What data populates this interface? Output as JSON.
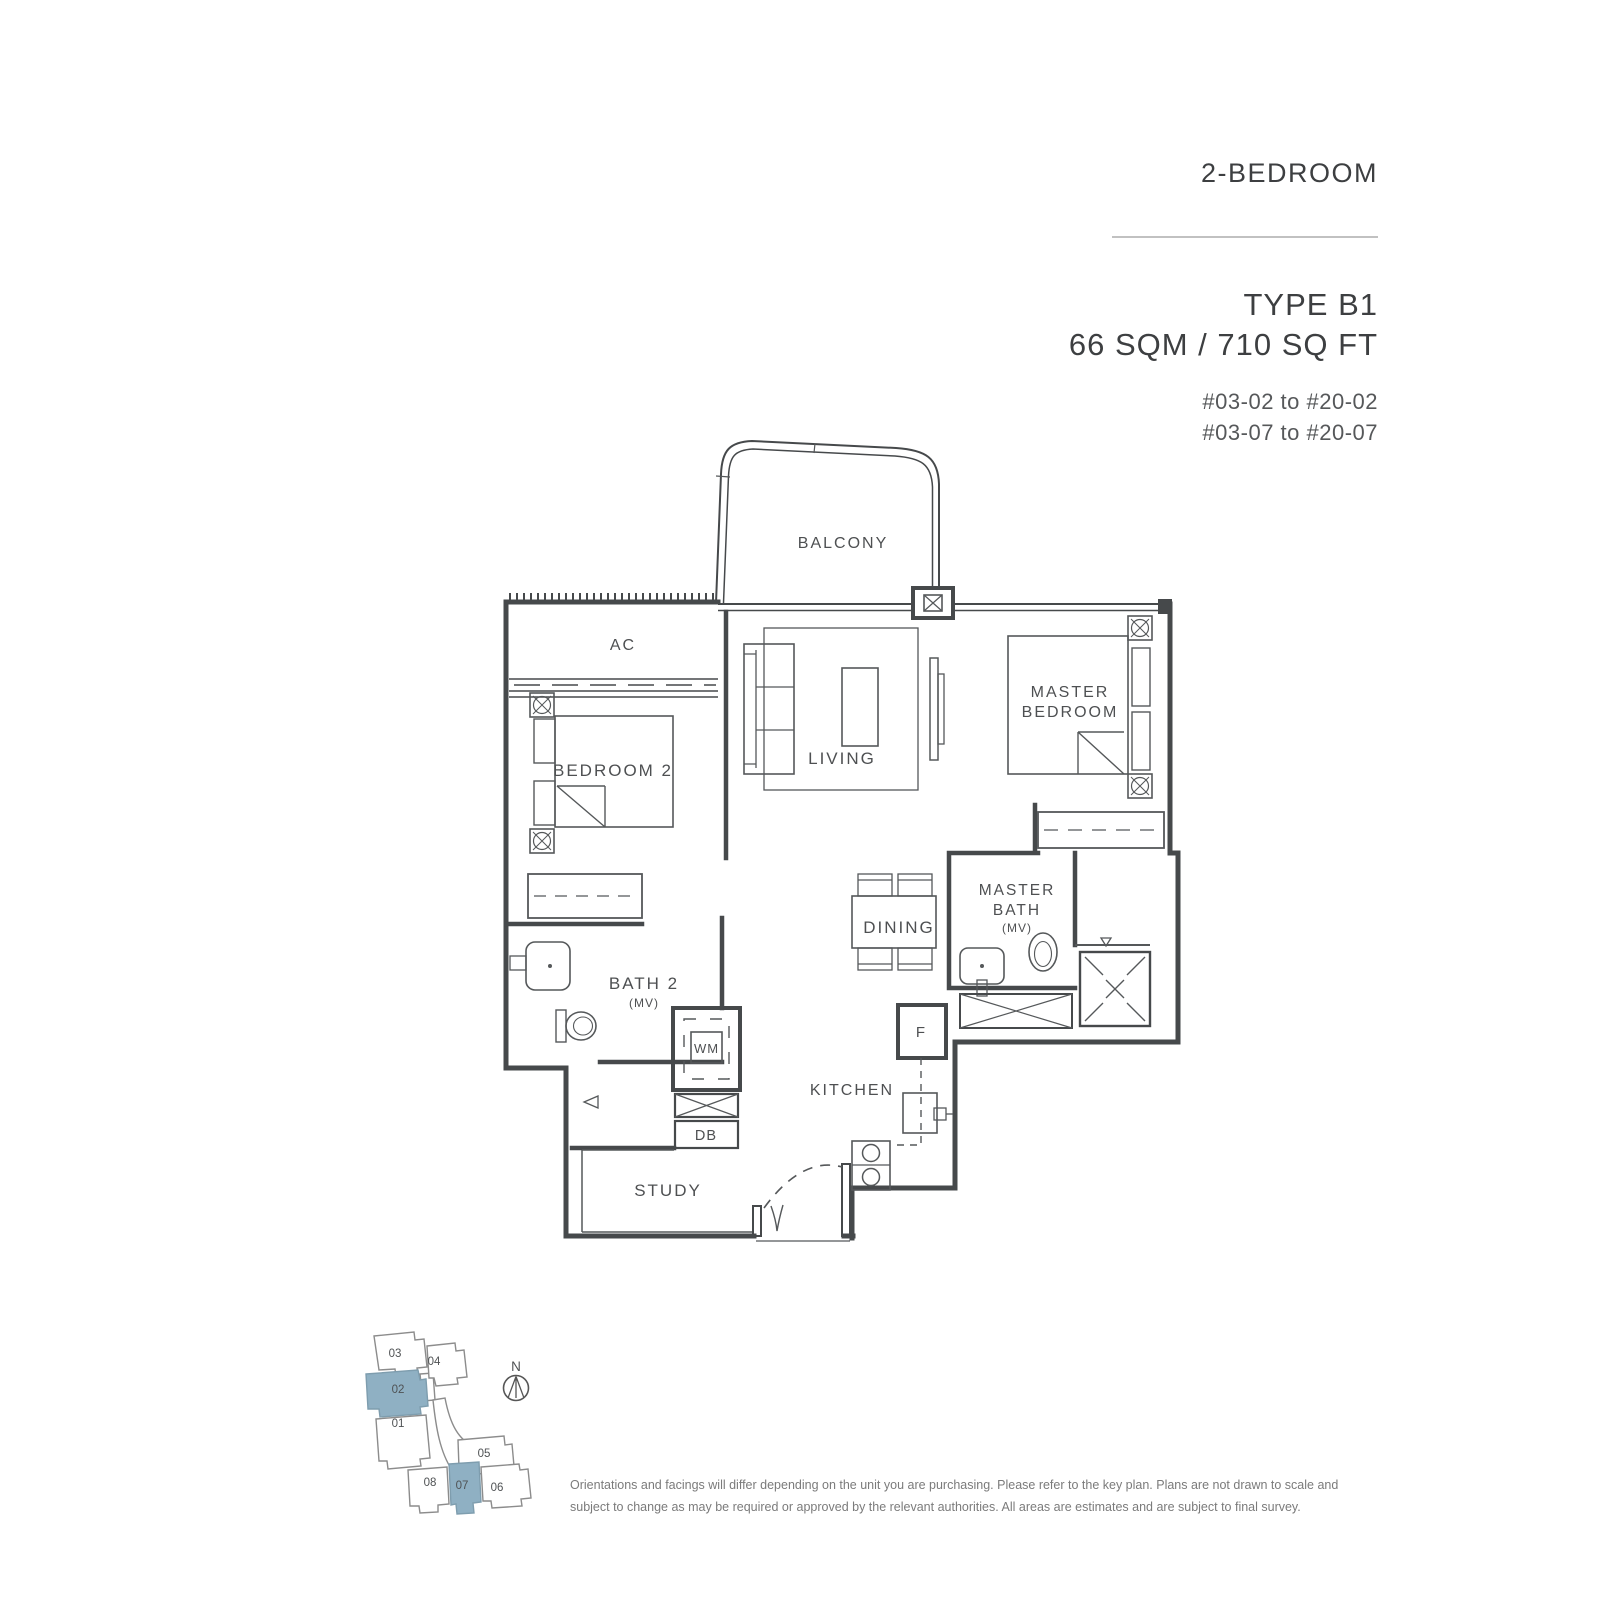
{
  "header": {
    "category": "2-BEDROOM",
    "unit_type": "TYPE B1",
    "area": "66 SQM / 710 SQ FT",
    "stacks": [
      "#03-02 to #20-02",
      "#03-07 to #20-07"
    ]
  },
  "plan_labels": {
    "balcony": "BALCONY",
    "ac": "AC",
    "bedroom2": "BEDROOM 2",
    "living": "LIVING",
    "master_line1": "MASTER",
    "master_line2": "BEDROOM",
    "dining": "DINING",
    "master_bath_line1": "MASTER",
    "master_bath_line2": "BATH",
    "master_bath_mv": "(MV)",
    "bath2": "BATH 2",
    "bath2_mv": "(MV)",
    "wm": "WM",
    "db": "DB",
    "kitchen": "KITCHEN",
    "study": "STUDY",
    "fridge": "F"
  },
  "keyplan": {
    "north_label": "N",
    "units": [
      {
        "id": "03",
        "highlighted": false
      },
      {
        "id": "04",
        "highlighted": false
      },
      {
        "id": "02",
        "highlighted": true
      },
      {
        "id": "01",
        "highlighted": false
      },
      {
        "id": "05",
        "highlighted": false
      },
      {
        "id": "08",
        "highlighted": false
      },
      {
        "id": "07",
        "highlighted": true
      },
      {
        "id": "06",
        "highlighted": false
      }
    ]
  },
  "disclaimer": {
    "line1": "Orientations and facings will differ depending on the unit you are purchasing. Please refer to the key plan. Plans are not drawn to scale and",
    "line2": "subject to change as may be required or approved by the relevant authorities. All areas are estimates and are subject to final survey."
  },
  "colors": {
    "wall_line": "#46494b",
    "text": "#4e5052",
    "keyplan_highlight": "#8fb0c3",
    "divider": "#c1c1c1"
  }
}
